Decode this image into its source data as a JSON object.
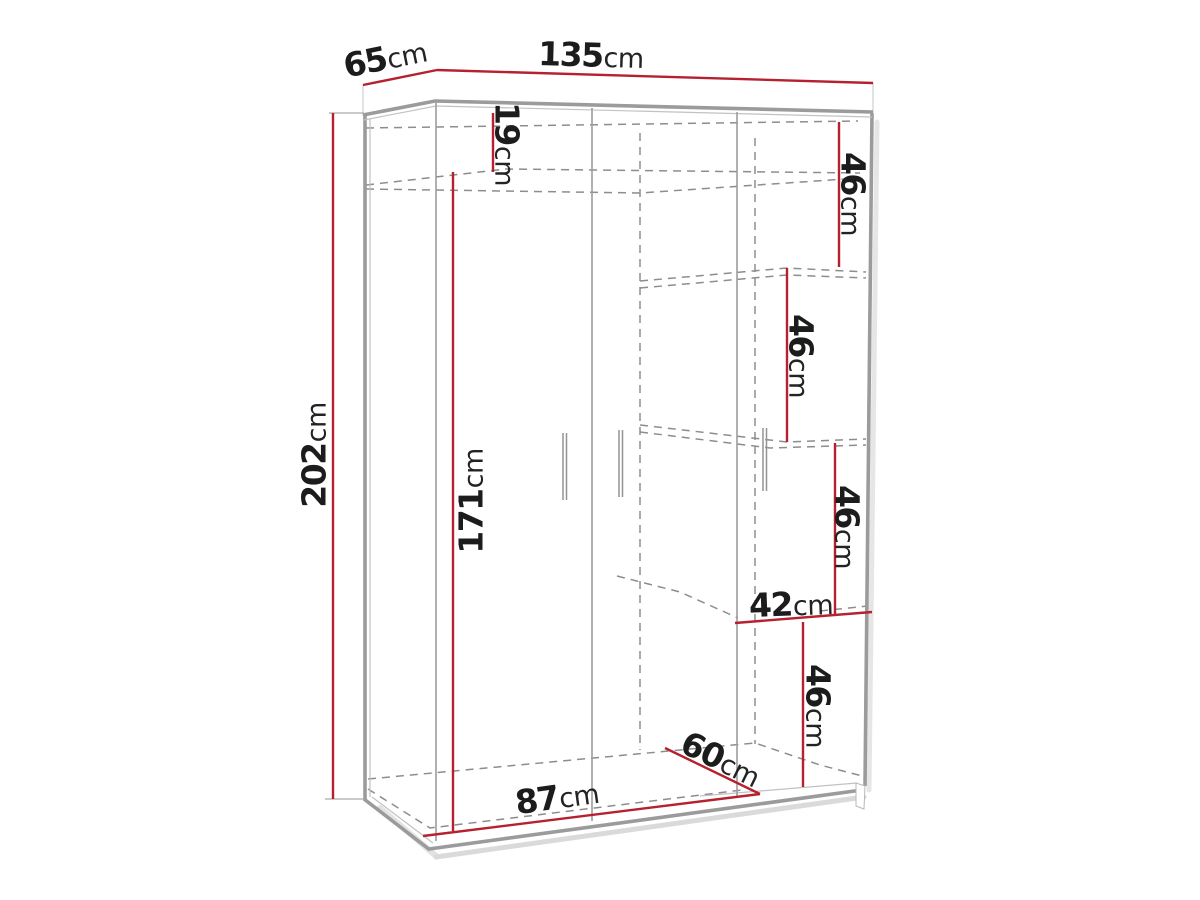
{
  "diagram": {
    "type": "furniture-dimension-diagram",
    "subject": "three-door wardrobe technical line drawing with interior shelves",
    "unit": "cm",
    "colors": {
      "dimension_line": "#b5212e",
      "outline": "#9b9b9b",
      "hidden_line": "#8d8d8d",
      "label_text": "#1c1c1c",
      "background": "#ffffff"
    },
    "labels": [
      {
        "id": "depth-top",
        "value": "65",
        "unit": "cm"
      },
      {
        "id": "width-top",
        "value": "135",
        "unit": "cm"
      },
      {
        "id": "height-left",
        "value": "202",
        "unit": "cm"
      },
      {
        "id": "top-shelf-height",
        "value": "19",
        "unit": "cm"
      },
      {
        "id": "door-height",
        "value": "171",
        "unit": "cm"
      },
      {
        "id": "right-shelf-1",
        "value": "46",
        "unit": "cm"
      },
      {
        "id": "right-shelf-2",
        "value": "46",
        "unit": "cm"
      },
      {
        "id": "right-shelf-3",
        "value": "46",
        "unit": "cm"
      },
      {
        "id": "shelf-width",
        "value": "42",
        "unit": "cm"
      },
      {
        "id": "right-shelf-4",
        "value": "46",
        "unit": "cm"
      },
      {
        "id": "interior-depth",
        "value": "60",
        "unit": "cm"
      },
      {
        "id": "interior-width",
        "value": "87",
        "unit": "cm"
      }
    ]
  }
}
